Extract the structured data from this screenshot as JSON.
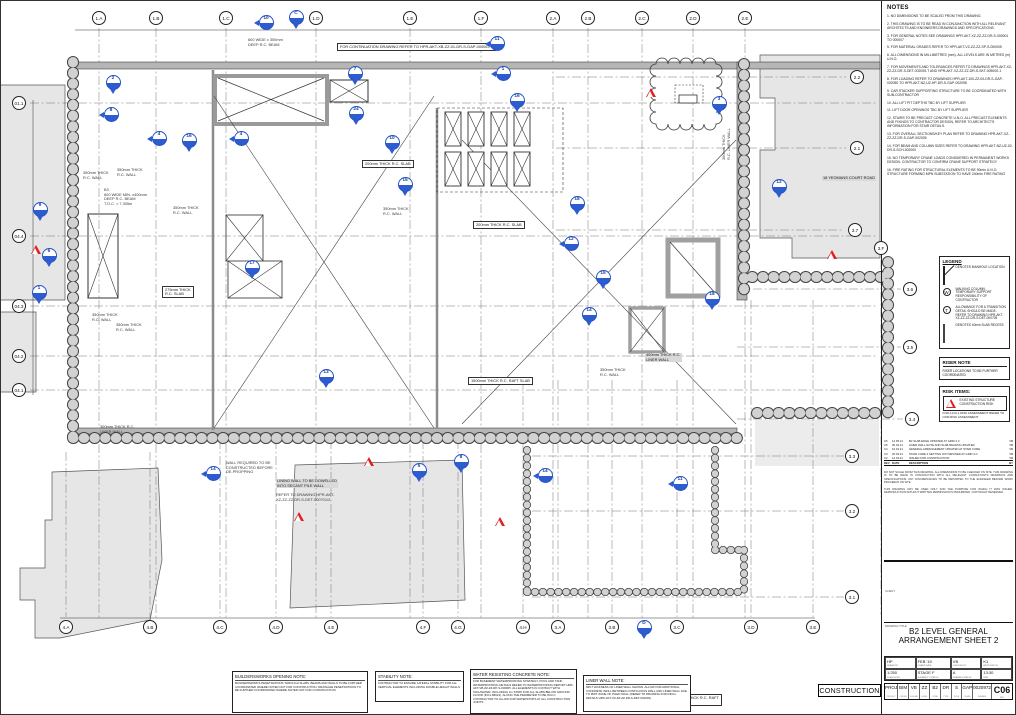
{
  "colors": {
    "marker_blue": "#2353c4",
    "risk_red": "#e02020",
    "wall_gray": "#b6b6b6",
    "shade_gray": "#e6e6e6"
  },
  "continuation_note": "FOR CONTINUATION DRAWING REFER TO HPR-AKT-XB-ZZ-01-DR-S-GAP-000067/1",
  "notes_panel": {
    "title": "NOTES",
    "items": [
      "1. NO DIMENSIONS TO BE SCALED FROM THIS DRAWING.",
      "2. THIS DRAWING IS TO BE READ IN CONJUNCTION WITH ALL RELEVANT ARCHITECTS AND ENGINEERS DRAWINGS AND SPECIFICATIONS.",
      "3. FOR GENERAL NOTES SEE DRAWINGS HPR-AKT-XZ-ZZ-ZZ-DR-S-000001 TO 000007",
      "5. FOR MATERIAL GRADES REFER TO HPR-AKT-VZ-ZZ-ZZ-SP-S-000005",
      "6. ALL DIMENSIONS IN MILLIMETRES (mm). ALL LEVELS ARE IN METRES (m) U.N.O.",
      "7. FOR MOVEMENTS AND TOLERANCES REFER TO DRAWINGS HPR-AKT-XZ-ZZ-ZZ-DR-S-DET-002005-T AND HPR-AKT-VZ-ZZ-ZZ-DR-S-SKT-005000-1",
      "8. FOR LOADING REFER TO DRAWINGS HPR-AKT-100-ZZ-00-DR-S-GAP-002050 TO HPR-AKT-NZ-UZ-HP-DR-S-GAP-002098",
      "9. CAR STACKER SUPPORTING STRUCTURE TO BE COORDINATED WITH SUB-CONTRACTOR",
      "10. ALL LIFT PIT DEPTHS TBC BY LIFT SUPPLIER",
      "11. LIFT DOOR OPENINGS TBC BY LIFT SUPPLIER",
      "12. STAIRS TO BE PRECAST CONCRETE U.N.O. ALL PRECAST ELEMENTS AND FIXINGS TO CONTRACTOR DESIGN, REFER TO ARCHITECTS INFORMATION FOR STAIR DETAILS.",
      "13. FOR OVERALL SECTIONS/KEY PLAN REFER TO DRAWING HPR-AKT-XZ-ZZ-ZZ-DR-S-GAP-002005",
      "14. FOR BEAM AND COLUMN SIZES REFER TO DRAWING HPR-AKT-NZ-UZ-02-DR-S-SCH-002000",
      "15. NO TEMPORARY CRANE LOADS CONSIDERED IN PERMANENT WORKS DESIGN. CONTRACTOR TO CONFIRM CRANE SUPPORT STRATEGY",
      "16. FIRE RATING FOR STRUCTURAL ELEMENTS TO BE 90min U.N.O. STRUCTURE FORMING MPN SUBSTATION TO HAVE 240min FIRE RATING"
    ]
  },
  "legend": {
    "title": "LEGEND",
    "items": [
      {
        "icon": "ic-manhole",
        "glyph": "",
        "text": "DENOTES MANHOLE LOCATION"
      },
      {
        "icon": "ic-circle",
        "glyph": "W",
        "text": "WALKING COLUMN. TEMPORARY SUPPORT RESPONSIBILITY OF CONTRACTOR"
      },
      {
        "icon": "ic-circle",
        "glyph": "T",
        "text": "ALLOWANCE FOR A TRANSITION DETAIL SHOULD BE MADE. REFER TO DRAWING HPR-AKT-XZ-ZZ-ZZ-DR-S-DET-000705"
      },
      {
        "icon": "ic-recess",
        "glyph": "",
        "text": "DENOTES 40mm SLAB RECESS"
      }
    ]
  },
  "riser_note": {
    "title": "RISER NOTE",
    "body": "RISER LOCATIONS TO BE FURTHER COORDINATED"
  },
  "risk_items": {
    "title": "RISK ITEMS:",
    "item": "EXISTING STRUCTURE CONSTRUCTION RISK",
    "footer": "FOR A FULL RISK ASSESSMENT REFER TO CDM RISK ASSESSMENT"
  },
  "revision_table": {
    "headers": [
      "REV",
      "DATE",
      "DESCRIPTION",
      "BY"
    ],
    "rows": [
      [
        "C6",
        "14.05.21",
        "B2 SLAB EDGE UPDATED AT GRID 2.C",
        "VB"
      ],
      [
        "C5",
        "30.04.21",
        "LINER WALL NOTE AND SLAB RECESS UPDATED",
        "VB"
      ],
      [
        "C4",
        "16.04.21",
        "GENERAL ARRANGEMENT UPDATED AT STAIR CORE",
        "VB"
      ],
      [
        "C3",
        "26.03.21",
        "STAIR CORE 2 SETTING OUT REVISED AT GRID 3.C",
        "VB"
      ],
      [
        "C2",
        "12.03.21",
        "ISSUED FOR CONSTRUCTION",
        "VB"
      ]
    ]
  },
  "disclaimer": [
    "DO NOT SCALE FROM THIS DRAWING. ALL DIMENSIONS TO BE CHECKED ON SITE. THIS DRAWING IS TO BE READ IN CONJUNCTION WITH ALL RELEVANT CONSULTANTS DRAWINGS AND SPECIFICATIONS. ANY DISCREPANCIES TO BE REPORTED TO THE ENGINEER BEFORE WORK PROCEEDS ON SITE.",
    "THIS DRAWING MAY BE USED ONLY FOR THE PURPOSE FOR WHICH IT WAS ISSUED. REPRODUCTION WITHOUT WRITTEN PERMISSION IS PROHIBITED. COPYRIGHT RESERVED."
  ],
  "title_block": {
    "client_label": "CLIENT",
    "drawing_title_label": "DRAWING TITLE",
    "title_line1": "B2 LEVEL GENERAL",
    "title_line2": "ARRANGEMENT SHEET 2",
    "fields": [
      {
        "v": "HP",
        "s": "DRAWN BY"
      },
      {
        "v": "FEB '19",
        "s": "DRAWN DATE"
      },
      {
        "v": "VB",
        "s": "CHECKED BY"
      },
      {
        "v": "K1",
        "s": "APPROVED BY"
      },
      {
        "v": "1:250",
        "s": "SCALE AT A1"
      },
      {
        "v": "STAGE F",
        "s": "SUITABILITY STATUS"
      },
      {
        "v": "A",
        "s": "DRAWING STATUS"
      },
      {
        "v": "13:30",
        "s": "SIZE"
      }
    ],
    "code_parts": [
      {
        "v": "PROJ",
        "s": "PROJECT"
      },
      {
        "v": "BIM",
        "s": "ORIGIN"
      },
      {
        "v": "VB",
        "s": "VOLUME"
      },
      {
        "v": "ZZ",
        "s": "LEVEL"
      },
      {
        "v": "B2",
        "s": "ZONE"
      },
      {
        "v": "DR",
        "s": "TYPE"
      },
      {
        "v": "S",
        "s": "ROLE"
      },
      {
        "v": "GAP",
        "s": "CLASS"
      },
      {
        "v": "0020972",
        "s": "NUMBER"
      }
    ],
    "revision": {
      "v": "C06",
      "s": "REV"
    }
  },
  "stamp": "CONSTRUCTION",
  "bottom_notes": [
    {
      "title": "BUILDERSWORKS OPENING NOTE:",
      "body": "BUILDERSWORKS PENETRATIONS THROUGH SLABS, BEAMS AND WALLS TO BE FURTHER COORDINATED WHERE NOTED NOT FOR CONSTRUCTION. DRAINAGE PENETRATIONS TO BE FURTHER COORDINATED WHERE NOTED NOT FOR CONSTRUCTION"
    },
    {
      "title": "STABILITY NOTE:",
      "body": "CONTRACTOR TO ENSURE LATERAL STABILITY FOR ALL VERTICAL ELEMENTS INCLUDING DOUBLE HEIGHT WALLS"
    },
    {
      "title": "WATER RESISTING CONCRETE NOTE:",
      "body": "FOR BASEMENT WATERPROOFING STRATEGY, POOL AND TANK WATERPROOFING DETAILS REFER TO WATERPROOFING REPORT HPR-AKT-VB-ZZ-ZZ-RP-S-000005. ALL ELEMENTS IN CONTACT WITH SOIL/WATER, INCLUDING 1m STRIP FOR ALL SLABS BELOW GROUND FLOOR (INCL BDGS), ALONG THE PERIMETER TO BE W.R.C. CONTRACTOR TO ALLOW FOR WATERSTOPS AT ALL CONSTRUCTION JOINTS"
    },
    {
      "title": "LINER WALL NOTE:",
      "body": "MIN THICKNESS OF LINER WALL SHOWN. ALLOW FOR ADDITIONAL CONCRETE INFILL BETWEEN CONTIGUOUS WALL AND LINER WALL DUE TO MWT ZONE OF PILED WALL (REFER TO DRAWING FOR INFILL DETAILS HPR-AKT-XZ-ZZ-ZZ-DR-S-DET-002004)"
    }
  ],
  "grid": {
    "bubbles": [
      {
        "x": 99,
        "y": 18,
        "l": "1.A",
        "o": "v",
        "line": [
          28,
          620
        ]
      },
      {
        "x": 156,
        "y": 18,
        "l": "1.B",
        "o": "v",
        "line": [
          28,
          620
        ]
      },
      {
        "x": 226,
        "y": 18,
        "l": "1.C",
        "o": "v",
        "line": [
          28,
          620
        ]
      },
      {
        "x": 316,
        "y": 18,
        "l": "1.D",
        "o": "v",
        "line": [
          28,
          620
        ]
      },
      {
        "x": 410,
        "y": 18,
        "l": "1.E",
        "o": "v",
        "line": [
          28,
          620
        ]
      },
      {
        "x": 481,
        "y": 18,
        "l": "1.F",
        "o": "v",
        "line": [
          28,
          620
        ]
      },
      {
        "x": 553,
        "y": 18,
        "l": "2.A",
        "o": "v",
        "line": [
          28,
          620
        ]
      },
      {
        "x": 588,
        "y": 18,
        "l": "2.B",
        "o": "v",
        "line": [
          28,
          620
        ]
      },
      {
        "x": 642,
        "y": 18,
        "l": "2.C",
        "o": "v",
        "line": [
          28,
          620
        ]
      },
      {
        "x": 693,
        "y": 18,
        "l": "2.D",
        "o": "v",
        "line": [
          28,
          620
        ]
      },
      {
        "x": 745,
        "y": 18,
        "l": "2.E",
        "o": "v",
        "line": [
          28,
          620
        ]
      },
      {
        "x": 66,
        "y": 627,
        "l": "4.A",
        "o": "v",
        "line": [
          452,
          617
        ]
      },
      {
        "x": 150,
        "y": 627,
        "l": "4.B",
        "o": "v",
        "line": [
          452,
          617
        ]
      },
      {
        "x": 220,
        "y": 627,
        "l": "4.C",
        "o": "v",
        "line": [
          440,
          617
        ]
      },
      {
        "x": 276,
        "y": 627,
        "l": "4.D",
        "o": "v",
        "line": [
          440,
          617
        ]
      },
      {
        "x": 331,
        "y": 627,
        "l": "4.E",
        "o": "v",
        "line": [
          440,
          617
        ]
      },
      {
        "x": 423,
        "y": 627,
        "l": "4.F",
        "o": "v",
        "line": [
          440,
          617
        ]
      },
      {
        "x": 458,
        "y": 627,
        "l": "4.G",
        "o": "v",
        "line": [
          440,
          617
        ]
      },
      {
        "x": 523,
        "y": 627,
        "l": "4.H",
        "o": "v",
        "line": [
          380,
          617
        ]
      },
      {
        "x": 558,
        "y": 627,
        "l": "3.A",
        "o": "v",
        "line": [
          380,
          617
        ]
      },
      {
        "x": 612,
        "y": 627,
        "l": "3.B",
        "o": "v",
        "line": [
          380,
          617
        ]
      },
      {
        "x": 677,
        "y": 627,
        "l": "3.C",
        "o": "v",
        "line": [
          380,
          617
        ]
      },
      {
        "x": 751,
        "y": 627,
        "l": "3.D",
        "o": "v",
        "line": [
          300,
          617
        ]
      },
      {
        "x": 813,
        "y": 627,
        "l": "3.E",
        "o": "v",
        "line": [
          300,
          617
        ]
      },
      {
        "x": 19,
        "y": 103,
        "l": "01.1",
        "o": "h",
        "line": [
          30,
          878
        ]
      },
      {
        "x": 19,
        "y": 236,
        "l": "04.4",
        "o": "h",
        "line": [
          30,
          878
        ]
      },
      {
        "x": 19,
        "y": 306,
        "l": "04.3",
        "o": "h",
        "line": [
          30,
          878
        ]
      },
      {
        "x": 19,
        "y": 356,
        "l": "04.2",
        "o": "h",
        "line": [
          30,
          878
        ]
      },
      {
        "x": 19,
        "y": 390,
        "l": "04.1",
        "o": "h",
        "line": [
          30,
          878
        ]
      },
      {
        "x": 857,
        "y": 77,
        "l": "2.2",
        "o": "h",
        "line": [
          556,
          846
        ]
      },
      {
        "x": 857,
        "y": 148,
        "l": "2.1",
        "o": "h",
        "line": [
          556,
          846
        ]
      },
      {
        "x": 855,
        "y": 230,
        "l": "3.7",
        "o": "h",
        "line": [
          556,
          844
        ]
      },
      {
        "x": 881,
        "y": 248,
        "l": "3.F",
        "o": "v",
        "line": [
          260,
          615
        ]
      },
      {
        "x": 910,
        "y": 289,
        "l": "3.6",
        "o": "h",
        "line": [
          737,
          901
        ]
      },
      {
        "x": 910,
        "y": 347,
        "l": "3.5",
        "o": "h",
        "line": [
          737,
          901
        ]
      },
      {
        "x": 912,
        "y": 419,
        "l": "3.4",
        "o": "h",
        "line": [
          737,
          903
        ]
      },
      {
        "x": 852,
        "y": 456,
        "l": "3.3",
        "o": "h",
        "line": [
          532,
          844
        ]
      },
      {
        "x": 852,
        "y": 511,
        "l": "3.2",
        "o": "h",
        "line": [
          532,
          844
        ]
      },
      {
        "x": 852,
        "y": 597,
        "l": "3.1",
        "o": "h",
        "line": [
          532,
          844
        ]
      }
    ]
  },
  "markers": [
    {
      "x": 266,
      "y": 22,
      "n": "10",
      "d": "l"
    },
    {
      "x": 296,
      "y": 17,
      "n": "C",
      "d": "d"
    },
    {
      "x": 497,
      "y": 43,
      "n": "11",
      "d": "l"
    },
    {
      "x": 503,
      "y": 73,
      "n": "1",
      "d": "l"
    },
    {
      "x": 517,
      "y": 100,
      "n": "16",
      "d": "d"
    },
    {
      "x": 113,
      "y": 82,
      "n": "2",
      "d": "d"
    },
    {
      "x": 111,
      "y": 114,
      "n": "8",
      "d": "l"
    },
    {
      "x": 159,
      "y": 138,
      "n": "4",
      "d": "l"
    },
    {
      "x": 189,
      "y": 140,
      "n": "16",
      "d": "d"
    },
    {
      "x": 241,
      "y": 138,
      "n": "4",
      "d": "l"
    },
    {
      "x": 355,
      "y": 73,
      "n": "7",
      "d": "d"
    },
    {
      "x": 356,
      "y": 113,
      "n": "24",
      "d": "d"
    },
    {
      "x": 392,
      "y": 142,
      "n": "10",
      "d": "d"
    },
    {
      "x": 405,
      "y": 184,
      "n": "15",
      "d": "d"
    },
    {
      "x": 40,
      "y": 209,
      "n": "9",
      "d": "d"
    },
    {
      "x": 49,
      "y": 255,
      "n": "6",
      "d": "d"
    },
    {
      "x": 39,
      "y": 292,
      "n": "1",
      "d": "d"
    },
    {
      "x": 252,
      "y": 267,
      "n": "17",
      "d": "d"
    },
    {
      "x": 326,
      "y": 376,
      "n": "13",
      "d": "d"
    },
    {
      "x": 719,
      "y": 103,
      "n": "3",
      "d": "d"
    },
    {
      "x": 779,
      "y": 186,
      "n": "12",
      "d": "d"
    },
    {
      "x": 577,
      "y": 203,
      "n": "18",
      "d": "d"
    },
    {
      "x": 571,
      "y": 243,
      "n": "12",
      "d": "l"
    },
    {
      "x": 603,
      "y": 277,
      "n": "15",
      "d": "d"
    },
    {
      "x": 589,
      "y": 314,
      "n": "14",
      "d": "d"
    },
    {
      "x": 712,
      "y": 298,
      "n": "18",
      "d": "d"
    },
    {
      "x": 213,
      "y": 473,
      "n": "14",
      "d": "l"
    },
    {
      "x": 419,
      "y": 470,
      "n": "5",
      "d": "d"
    },
    {
      "x": 461,
      "y": 461,
      "n": "8",
      "d": "d"
    },
    {
      "x": 545,
      "y": 475,
      "n": "14",
      "d": "l"
    },
    {
      "x": 680,
      "y": 483,
      "n": "11",
      "d": "l"
    },
    {
      "x": 644,
      "y": 627,
      "n": "D",
      "d": "d"
    }
  ],
  "risk_triangles": [
    {
      "x": 36,
      "y": 254
    },
    {
      "x": 369,
      "y": 466
    },
    {
      "x": 500,
      "y": 526
    },
    {
      "x": 299,
      "y": 521
    },
    {
      "x": 832,
      "y": 259
    },
    {
      "x": 651,
      "y": 97
    }
  ],
  "plan_labels": [
    {
      "x": 337,
      "y": 43,
      "t": "FOR CONTINUATION DRAWING REFER TO HPR-AKT-XB-ZZ-01-DR-S-GAP-000067/1",
      "c": "boxed"
    },
    {
      "x": 248,
      "y": 38,
      "t": "600 WIDE x 300mm\nDEEP R.C. BEAM"
    },
    {
      "x": 83,
      "y": 171,
      "t": "350mm THICK\nR.C. WALL"
    },
    {
      "x": 117,
      "y": 168,
      "t": "350mm THICK\nR.C. WALL"
    },
    {
      "x": 173,
      "y": 206,
      "t": "350mm THICK\nR.C. WALL"
    },
    {
      "x": 383,
      "y": 207,
      "t": "350mm THICK\nR.C. WALL"
    },
    {
      "x": 92,
      "y": 313,
      "t": "350mm THICK\nR.C. WALL"
    },
    {
      "x": 116,
      "y": 323,
      "t": "350mm THICK\nR.C. WALL"
    },
    {
      "x": 104,
      "y": 188,
      "t": "B3\n600 WIDE MIN. x400mm\nDEEP R.C. BEAM\nT.O.C. ≈ 7.305m"
    },
    {
      "x": 162,
      "y": 286,
      "t": "275mm THICK\nR.C. SLAB",
      "c": "boxed"
    },
    {
      "x": 362,
      "y": 160,
      "t": "200mm THICK R.C. SLAB",
      "c": "boxed"
    },
    {
      "x": 473,
      "y": 221,
      "t": "200mm THICK R.C. SLAB",
      "c": "boxed"
    },
    {
      "x": 100,
      "y": 425,
      "t": "300mm THICK R.C.\nLINER WALL"
    },
    {
      "x": 226,
      "y": 461,
      "t": "WALL REQUIRED TO BE\nCONSTRUCTED BEFORE\nDE-PROPPING"
    },
    {
      "x": 276,
      "y": 479,
      "t": "LINING WALL TO BE DOWELLED\nINTO SECANT PILE WALL",
      "c": "gbg"
    },
    {
      "x": 276,
      "y": 493,
      "t": "REFER TO DRAWING HPR-AKT-\nXZ-ZZ-ZZ-DR-S-DET-000701/2"
    },
    {
      "x": 822,
      "y": 176,
      "t": "18 YEOMANS COURT ROAD",
      "c": "gbg"
    },
    {
      "x": 722,
      "y": 160,
      "t": "300mm THICK\nR.C. LINER WALL",
      "c": "rot"
    },
    {
      "x": 645,
      "y": 353,
      "t": "400mm THICK R.C.\nLINER WALL",
      "c": "gbg"
    },
    {
      "x": 600,
      "y": 368,
      "t": "350mm THICK\nR.C. WALL"
    },
    {
      "x": 468,
      "y": 377,
      "t": "1500mm THICK R.C. RAFT SLAB",
      "c": "boxed"
    },
    {
      "x": 668,
      "y": 694,
      "t": "1500mm THICK R.C. RAFT\nSLAB",
      "c": "boxed"
    }
  ]
}
